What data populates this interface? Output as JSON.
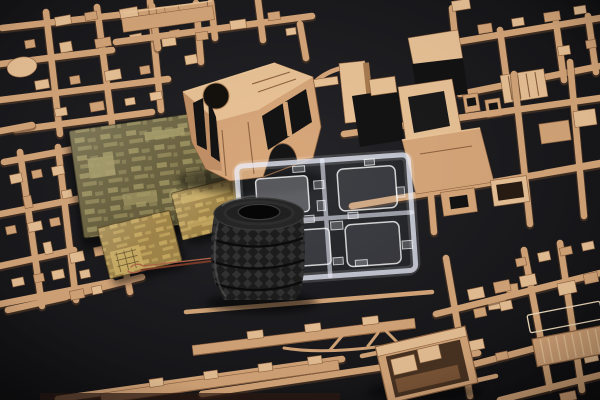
{
  "scene": {
    "title": "Plastic model kit contents photographed on a black background: tan sprues, photo-etched brass frets, clear window sprue, copper wire and stacked rubber tires",
    "items": [
      {
        "id": "sprue-top-left",
        "label": "tan plastic sprue with small parts"
      },
      {
        "id": "sprue-top-center",
        "label": "tan plastic sprue above cab"
      },
      {
        "id": "sprue-top-right",
        "label": "tan plastic sprue with seats and ribbed panel"
      },
      {
        "id": "sprue-right",
        "label": "tan plastic sprue with large body panels"
      },
      {
        "id": "sprue-left-edge",
        "label": "tan plastic sprue along left edge"
      },
      {
        "id": "sprue-chassis",
        "label": "sprue with long chassis rails"
      },
      {
        "id": "sprue-bottom-right",
        "label": "tan plastic sprue with slatted board"
      },
      {
        "id": "cargo-bed",
        "label": "open cargo-bed part"
      },
      {
        "id": "cab-body",
        "label": "truck cab shell with round roof-hatch hole"
      },
      {
        "id": "photo-etch-large",
        "label": "large photo-etched brass fret"
      },
      {
        "id": "photo-etch-small-left",
        "label": "small photo-etched brass fret"
      },
      {
        "id": "photo-etch-small-right",
        "label": "small photo-etched brass fret"
      },
      {
        "id": "copper-wire",
        "label": "twisted copper wire"
      },
      {
        "id": "tire-stack",
        "label": "stack of black rubber tires with diamond tread"
      },
      {
        "id": "clear-parts-sprue",
        "label": "clear sprue with four window panes"
      }
    ],
    "colors": {
      "bg_center": "#26262a",
      "bg_edge": "#0e0e10",
      "sprue_tan": "#d7a77a",
      "sprue_tan_light": "#eac397",
      "sprue_tan_dark": "#8f6340",
      "pe_olive": "#6b6340",
      "pe_olive_light": "#a89d68",
      "pe_gold": "#a3874a",
      "pe_gold_light": "#cfb267",
      "wire_copper": "#b4664a",
      "wire_copper_dark": "#7d3b28",
      "tire_black": "#1d1d1d",
      "tire_highlight": "#3a3a3a",
      "clear_stroke": "#eef2ff"
    }
  }
}
